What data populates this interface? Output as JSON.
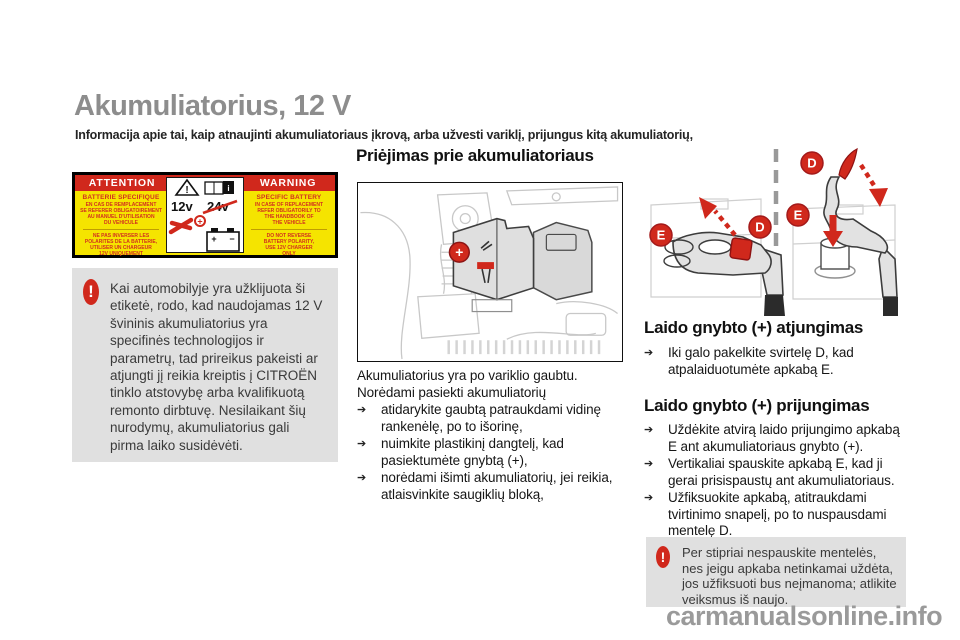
{
  "page": {
    "title": "Akumuliatorius, 12 V",
    "subtitle": "Informacija apie tai, kaip atnaujinti akumuliatoriaus įkrovą, arba užvesti variklį, prijungus kitą akumuliatorių,",
    "watermark": "carmanualsonline.info"
  },
  "colors": {
    "accent_red": "#d0281c",
    "label_yellow": "#f5e400",
    "title_gray": "#8d8d8d",
    "note_gray": "#e0e0e0",
    "watermark_gray": "#9a9a9a"
  },
  "icons": {
    "bullet_arrow": "➔",
    "exclamation": "!"
  },
  "labels": {
    "d": "D",
    "e": "E"
  },
  "battery_label": {
    "attention": "ATTENTION",
    "warning": "WARNING",
    "fr": {
      "title1": "BATTERIE SPECIFIQUE",
      "block1": [
        "EN CAS DE REMPLACEMENT",
        "SE REFERER OBLIGATOIREMENT",
        "AU MANUEL D'UTILISATION",
        "DU VEHICULE"
      ],
      "block2": [
        "NE PAS INVERSER LES",
        "POLARITES DE LA BATTERIE,",
        "UTILISER UN CHARGEUR",
        "12V UNIQUEMENT"
      ]
    },
    "en": {
      "title1": "SPECIFIC BATTERY",
      "block1": [
        "IN CASE OF REPLACEMENT",
        "REFER OBLIGATORILY TO",
        "THE HANDBOOK OF",
        "THE VEHICLE"
      ],
      "block2": [
        "DO NOT REVERSE",
        "BATTERY POLARITY,",
        "USE 12V CHARGER",
        "ONLY"
      ]
    },
    "center": {
      "v12": "12v",
      "v24": "24v",
      "info": "i",
      "excl": "!",
      "plus": "+",
      "minus": "−"
    }
  },
  "notes": {
    "left": "Kai automobilyje yra užklijuota ši etiketė, rodo, kad naudojamas 12 V švininis akumuliatorius yra specifinės technologijos ir parametrų, tad prireikus pakeisti ar atjungti jį reikia kreiptis į CITROËN tinklo atstovybę arba kvalifikuotą remonto dirbtuvę. Nesilaikant šių nurodymų, akumuliatorius gali pirma laiko susidėvėti.",
    "right": "Per stipriai nespauskite mentelės, nes jeigu apkaba netinkamai uždėta, jos užfiksuoti bus neįmanoma; atlikite veiksmus iš naujo."
  },
  "access": {
    "heading": "Priėjimas prie akumuliatoriaus",
    "intro_1": "Akumuliatorius yra po variklio gaubtu.",
    "intro_2": "Norėdami pasiekti akumuliatorių",
    "bullets": [
      "atidarykite gaubtą patraukdami vidinę rankenėlę, po to išorinę,",
      "nuimkite plastikinį dangtelį, kad pasiektumėte gnybtą (+),",
      "norėdami išimti akumuliatorių, jei reikia, atlaisvinkite saugiklių bloką,"
    ]
  },
  "disconnect": {
    "heading": "Laido gnybto (+) atjungimas",
    "bullets": [
      "Iki galo pakelkite svirtelę D, kad atpalaiduotumėte apkabą E."
    ]
  },
  "connect": {
    "heading": "Laido gnybto (+) prijungimas",
    "bullets": [
      "Uždėkite atvirą laido prijungimo apkabą E ant akumuliatoriaus gnybto (+).",
      "Vertikaliai spauskite apkabą E, kad ji gerai prisispaustų ant akumuliatoriaus.",
      "Užfiksuokite apkabą, atitraukdami tvirtinimo snapelį, po to nuspausdami mentelę D."
    ]
  },
  "figure": {
    "plus_terminal": "+"
  }
}
